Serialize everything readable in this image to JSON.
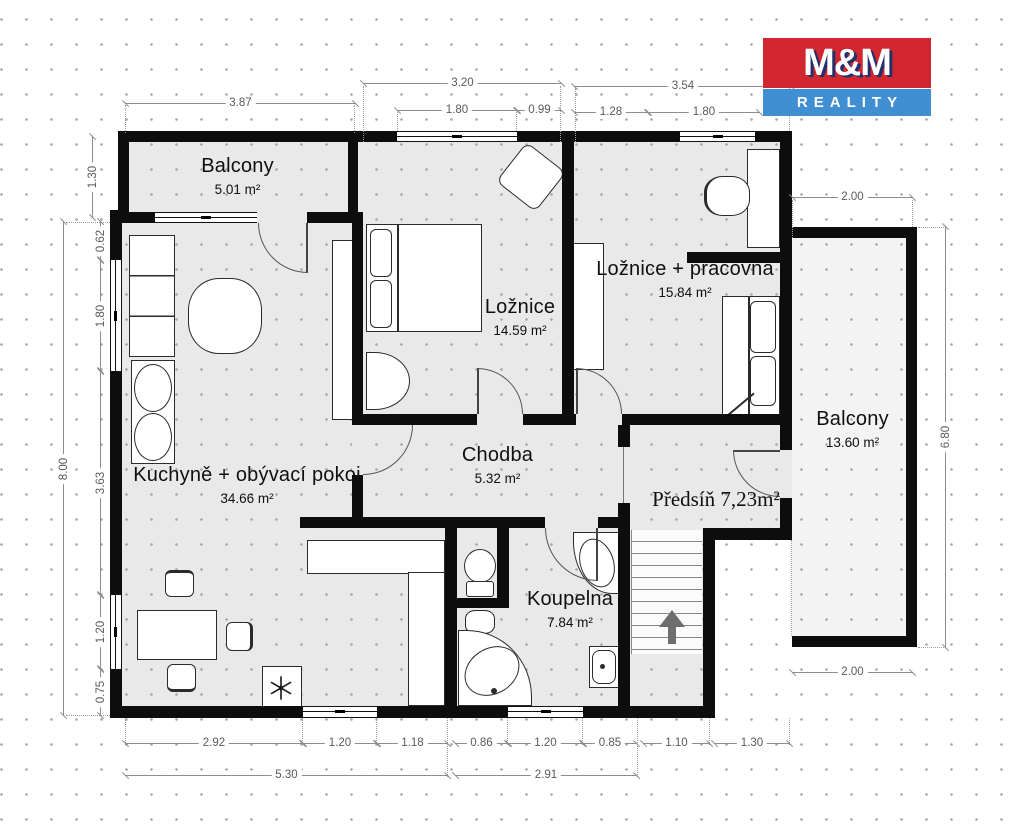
{
  "logo": {
    "top": "M&M",
    "bottom": "REALITY",
    "red": "#d22730",
    "blue": "#3f8fd2"
  },
  "rooms": {
    "balcony_tl": {
      "name": "Balcony",
      "area": "5.01 m²"
    },
    "loznice": {
      "name": "Ložnice",
      "area": "14.59 m²"
    },
    "pracovna": {
      "name": "Ložnice + pracovna",
      "area": "15.84 m²"
    },
    "balcony_r": {
      "name": "Balcony",
      "area": "13.60 m²"
    },
    "kuchyne": {
      "name": "Kuchyně + obývací pokoj",
      "area": "34.66 m²"
    },
    "chodba": {
      "name": "Chodba",
      "area": "5.32 m²"
    },
    "predsin": {
      "name": "Předsíň 7,23m²"
    },
    "koupelna": {
      "name": "Koupelna",
      "area": "7.84 m²"
    }
  },
  "dims": [
    "3.87",
    "3.20",
    "1.80",
    "0.99",
    "3.54",
    "1.28",
    "1.80",
    "2.00",
    "1.30",
    "8.00",
    "0.62",
    "1.80",
    "3.63",
    "1.20",
    "0.75",
    "6.80",
    "2.00",
    "2.92",
    "1.20",
    "1.18",
    "0.86",
    "1.20",
    "0.85",
    "1.10",
    "1.30",
    "5.30",
    "2.91"
  ]
}
